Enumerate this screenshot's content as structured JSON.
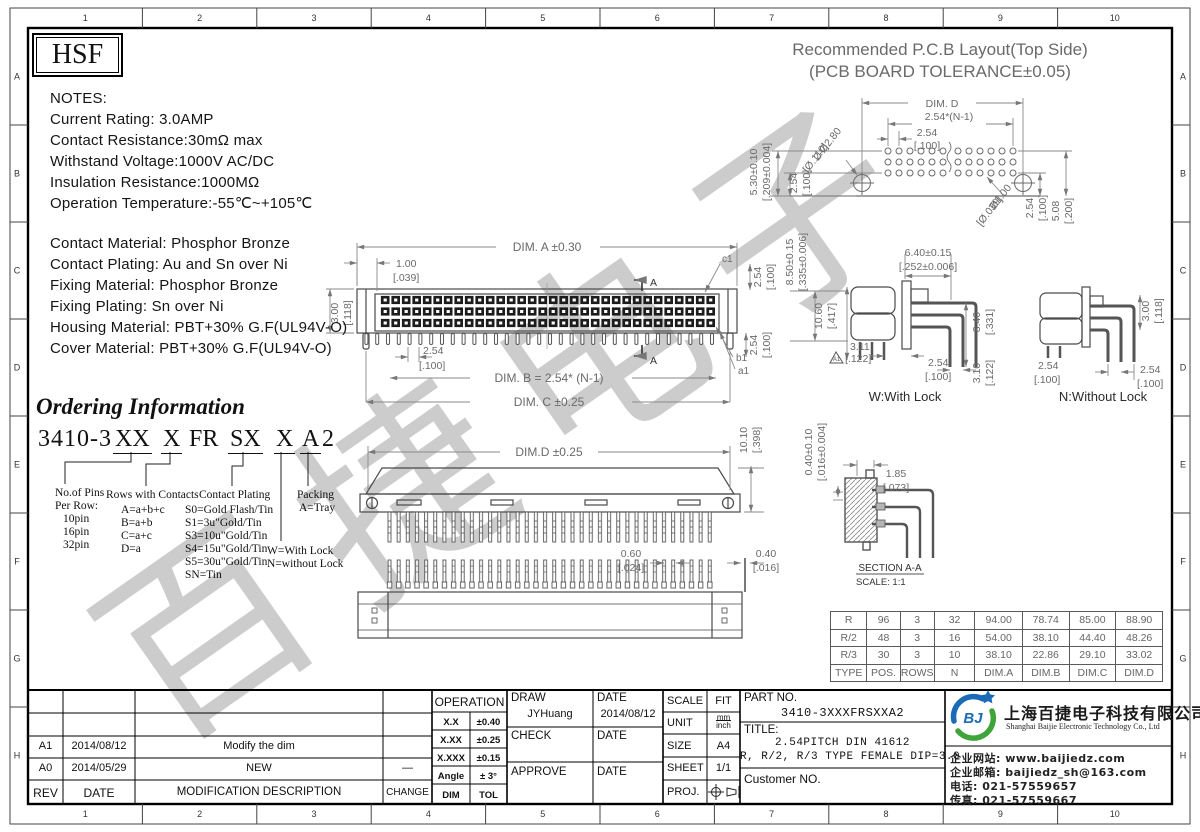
{
  "watermark": "百捷电子",
  "frame": {
    "cols": [
      "1",
      "2",
      "3",
      "4",
      "5",
      "6",
      "7",
      "8",
      "9",
      "10"
    ],
    "rows": [
      "A",
      "B",
      "C",
      "D",
      "E",
      "F",
      "G",
      "H"
    ]
  },
  "brand": {
    "logo": "HSF"
  },
  "notes": {
    "title": "NOTES:",
    "lines": [
      "Current Rating: 3.0AMP",
      "Contact Resistance:30mΩ max",
      "Withstand Voltage:1000V AC/DC",
      "Insulation Resistance:1000MΩ",
      "Operation Temperature:-55℃~+105℃"
    ]
  },
  "materials": [
    "Contact Material: Phosphor Bronze",
    "Contact Plating: Au and Sn over Ni",
    "Fixing Material: Phosphor Bronze",
    "Fixing Plating: Sn over Ni",
    "Housing Material: PBT+30% G.F(UL94V-O)",
    "Cover Material: PBT+30% G.F(UL94V-O)"
  ],
  "ordering": {
    "title": "Ordering Information",
    "code": {
      "base": "3410-3",
      "f1": "XX",
      "f2": "X",
      "f3": "FR",
      "f4": "SX",
      "f5": "X",
      "f6": "A",
      "f7": "2"
    },
    "pins": {
      "title": "No.of Pins",
      "sub": "Per Row:",
      "items": [
        "10pin",
        "16pin",
        "32pin"
      ]
    },
    "rows": {
      "title": "Rows with Contacts",
      "items": [
        "A=a+b+c",
        "B=a+b",
        "C=a+c",
        "D=a"
      ]
    },
    "plating": {
      "title": "Contact Plating",
      "items": [
        "S0=Gold Flash/Tin",
        "S1=3u\"Gold/Tin",
        "S3=10u\"Gold/Tin",
        "S4=15u\"Gold/Tin",
        "S5=30u\"Gold/Tin",
        "SN=Tin"
      ]
    },
    "lock": {
      "items": [
        "W=With Lock",
        "N=without Lock"
      ]
    },
    "packing": {
      "title": "Packing",
      "items": [
        "A=Tray"
      ]
    }
  },
  "pcb": {
    "title1": "Recommended P.C.B Layout(Top Side)",
    "title2": "(PCB BOARD TOLERANCE±0.05)",
    "dim_d": "DIM. D",
    "pitch": "2.54*(N-1)",
    "p1": "2.54",
    "p1b": "[.100]",
    "left1": "5.30±0.10",
    "left1b": "[.209±0.004]",
    "left2": "2.54",
    "left2b": "[.100]",
    "holes": "2-Ø2.80",
    "holesb": "[Ø.110]",
    "hole": "Ø1.00",
    "holeb": "[Ø.039]",
    "r1": "2.54",
    "r1b": "[.100]",
    "r2": "5.08",
    "r2b": "[.200]"
  },
  "front": {
    "dim_a": "DIM. A ±0.30",
    "w1": "1.00",
    "w1b": "[.039]",
    "h1": "3.00",
    "h1b": "[.118]",
    "p": "2.54",
    "pb": "[.100]",
    "dim_b": "DIM. B = 2.54* (N-1)",
    "dim_c": "DIM. C ±0.25",
    "c1": "c1",
    "b1": "b1",
    "a1": "a1",
    "rt": "2.54",
    "rtb": "[.100]",
    "rb": "2.54",
    "rbb": "[.100]",
    "sec": "A"
  },
  "wlock": {
    "lv1": "8.50±0.15",
    "lv1b": "[.335±0.006]",
    "lv2": "10.60",
    "lv2b": "[.417]",
    "top": "6.40±0.15",
    "topb": "[.252±0.006]",
    "rv": "8.40",
    "rvb": "[.331]",
    "d1": "3.11",
    "d1b": "[.122]",
    "tri": "A1",
    "d2": "2.54",
    "d2b": "[.100]",
    "d3": "3.10",
    "d3b": "[.122]",
    "label": "W:With Lock"
  },
  "nlock": {
    "rv": "3.00",
    "rvb": "[.118]",
    "d1": "2.54",
    "d1b": "[.100]",
    "d2": "2.54",
    "d2b": "[.100]",
    "label": "N:Without Lock"
  },
  "top_view": {
    "dim_d": "DIM.D ±0.25",
    "rv": "10.10",
    "rvb": "[.398]"
  },
  "bottom_view": {
    "d1": "0.60",
    "d1b": "[.024]",
    "d2": "0.40",
    "d2b": "[.016]"
  },
  "section": {
    "name": "SECTION A-A",
    "scale": "SCALE: 1:1",
    "lv": "0.40±0.10",
    "lvb": "[.016±0.004]",
    "d": "1.85",
    "db": "[.073]"
  },
  "spec_table": {
    "rows": [
      [
        "R",
        "96",
        "3",
        "32",
        "94.00",
        "78.74",
        "85.00",
        "88.90"
      ],
      [
        "R/2",
        "48",
        "3",
        "16",
        "54.00",
        "38.10",
        "44.40",
        "48.26"
      ],
      [
        "R/3",
        "30",
        "3",
        "10",
        "38.10",
        "22.86",
        "29.10",
        "33.02"
      ],
      [
        "TYPE",
        "POS.",
        "ROWS",
        "N",
        "DIM.A",
        "DIM.B",
        "DIM.C",
        "DIM.D"
      ]
    ]
  },
  "revisions": {
    "rows": [
      {
        "rev": "A1",
        "date": "2014/08/12",
        "desc": "Modify the dim",
        "change": ""
      },
      {
        "rev": "A0",
        "date": "2014/05/29",
        "desc": "NEW",
        "change": "—"
      }
    ],
    "header": {
      "rev": "REV",
      "date": "DATE",
      "desc": "MODIFICATION DESCRIPTION",
      "change": "CHANGE"
    }
  },
  "tolerances": {
    "title": "OPERATION",
    "rows": [
      [
        "X.X",
        "±0.40"
      ],
      [
        "X.XX",
        "±0.25"
      ],
      [
        "X.XXX",
        "±0.15"
      ],
      [
        "Angle",
        "± 3°"
      ],
      [
        "DIM",
        "TOL"
      ]
    ]
  },
  "approval": {
    "draw": "DRAW",
    "draw_name": "JYHuang",
    "date": "DATE",
    "draw_date": "2014/08/12",
    "check": "CHECK",
    "approve": "APPROVE"
  },
  "meta": {
    "scale_label": "SCALE",
    "scale": "FIT",
    "unit_label": "UNIT",
    "unit_mm": "mm",
    "unit_inch": "inch",
    "size_label": "SIZE",
    "size": "A4",
    "sheet_label": "SHEET",
    "sheet": "1/1",
    "proj_label": "PROJ."
  },
  "part": {
    "label": "PART NO.",
    "number": "3410-3XXXFRSXXA2",
    "title_label": "TITLE:",
    "title1": "2.54PITCH DIN 41612",
    "title2": "R, R/2, R/3 TYPE FEMALE DIP=3.0",
    "customer": "Customer NO."
  },
  "company": {
    "logo_text": "BJ",
    "name_cn": "上海百捷电子科技有限公司",
    "name_en": "Shanghai Baijie Electronic Technology Co., Ltd",
    "website": "企业网站: www.baijiedz.com",
    "email": "企业邮箱: baijiedz_sh@163.com",
    "tel": "电话: 021-57559657",
    "fax": "传真: 021-57559667"
  },
  "colors": {
    "line": "#4a4a4a",
    "dim": "#8a8a8a",
    "logo_blue": "#1b6cb5",
    "logo_green": "#3fa53a"
  }
}
